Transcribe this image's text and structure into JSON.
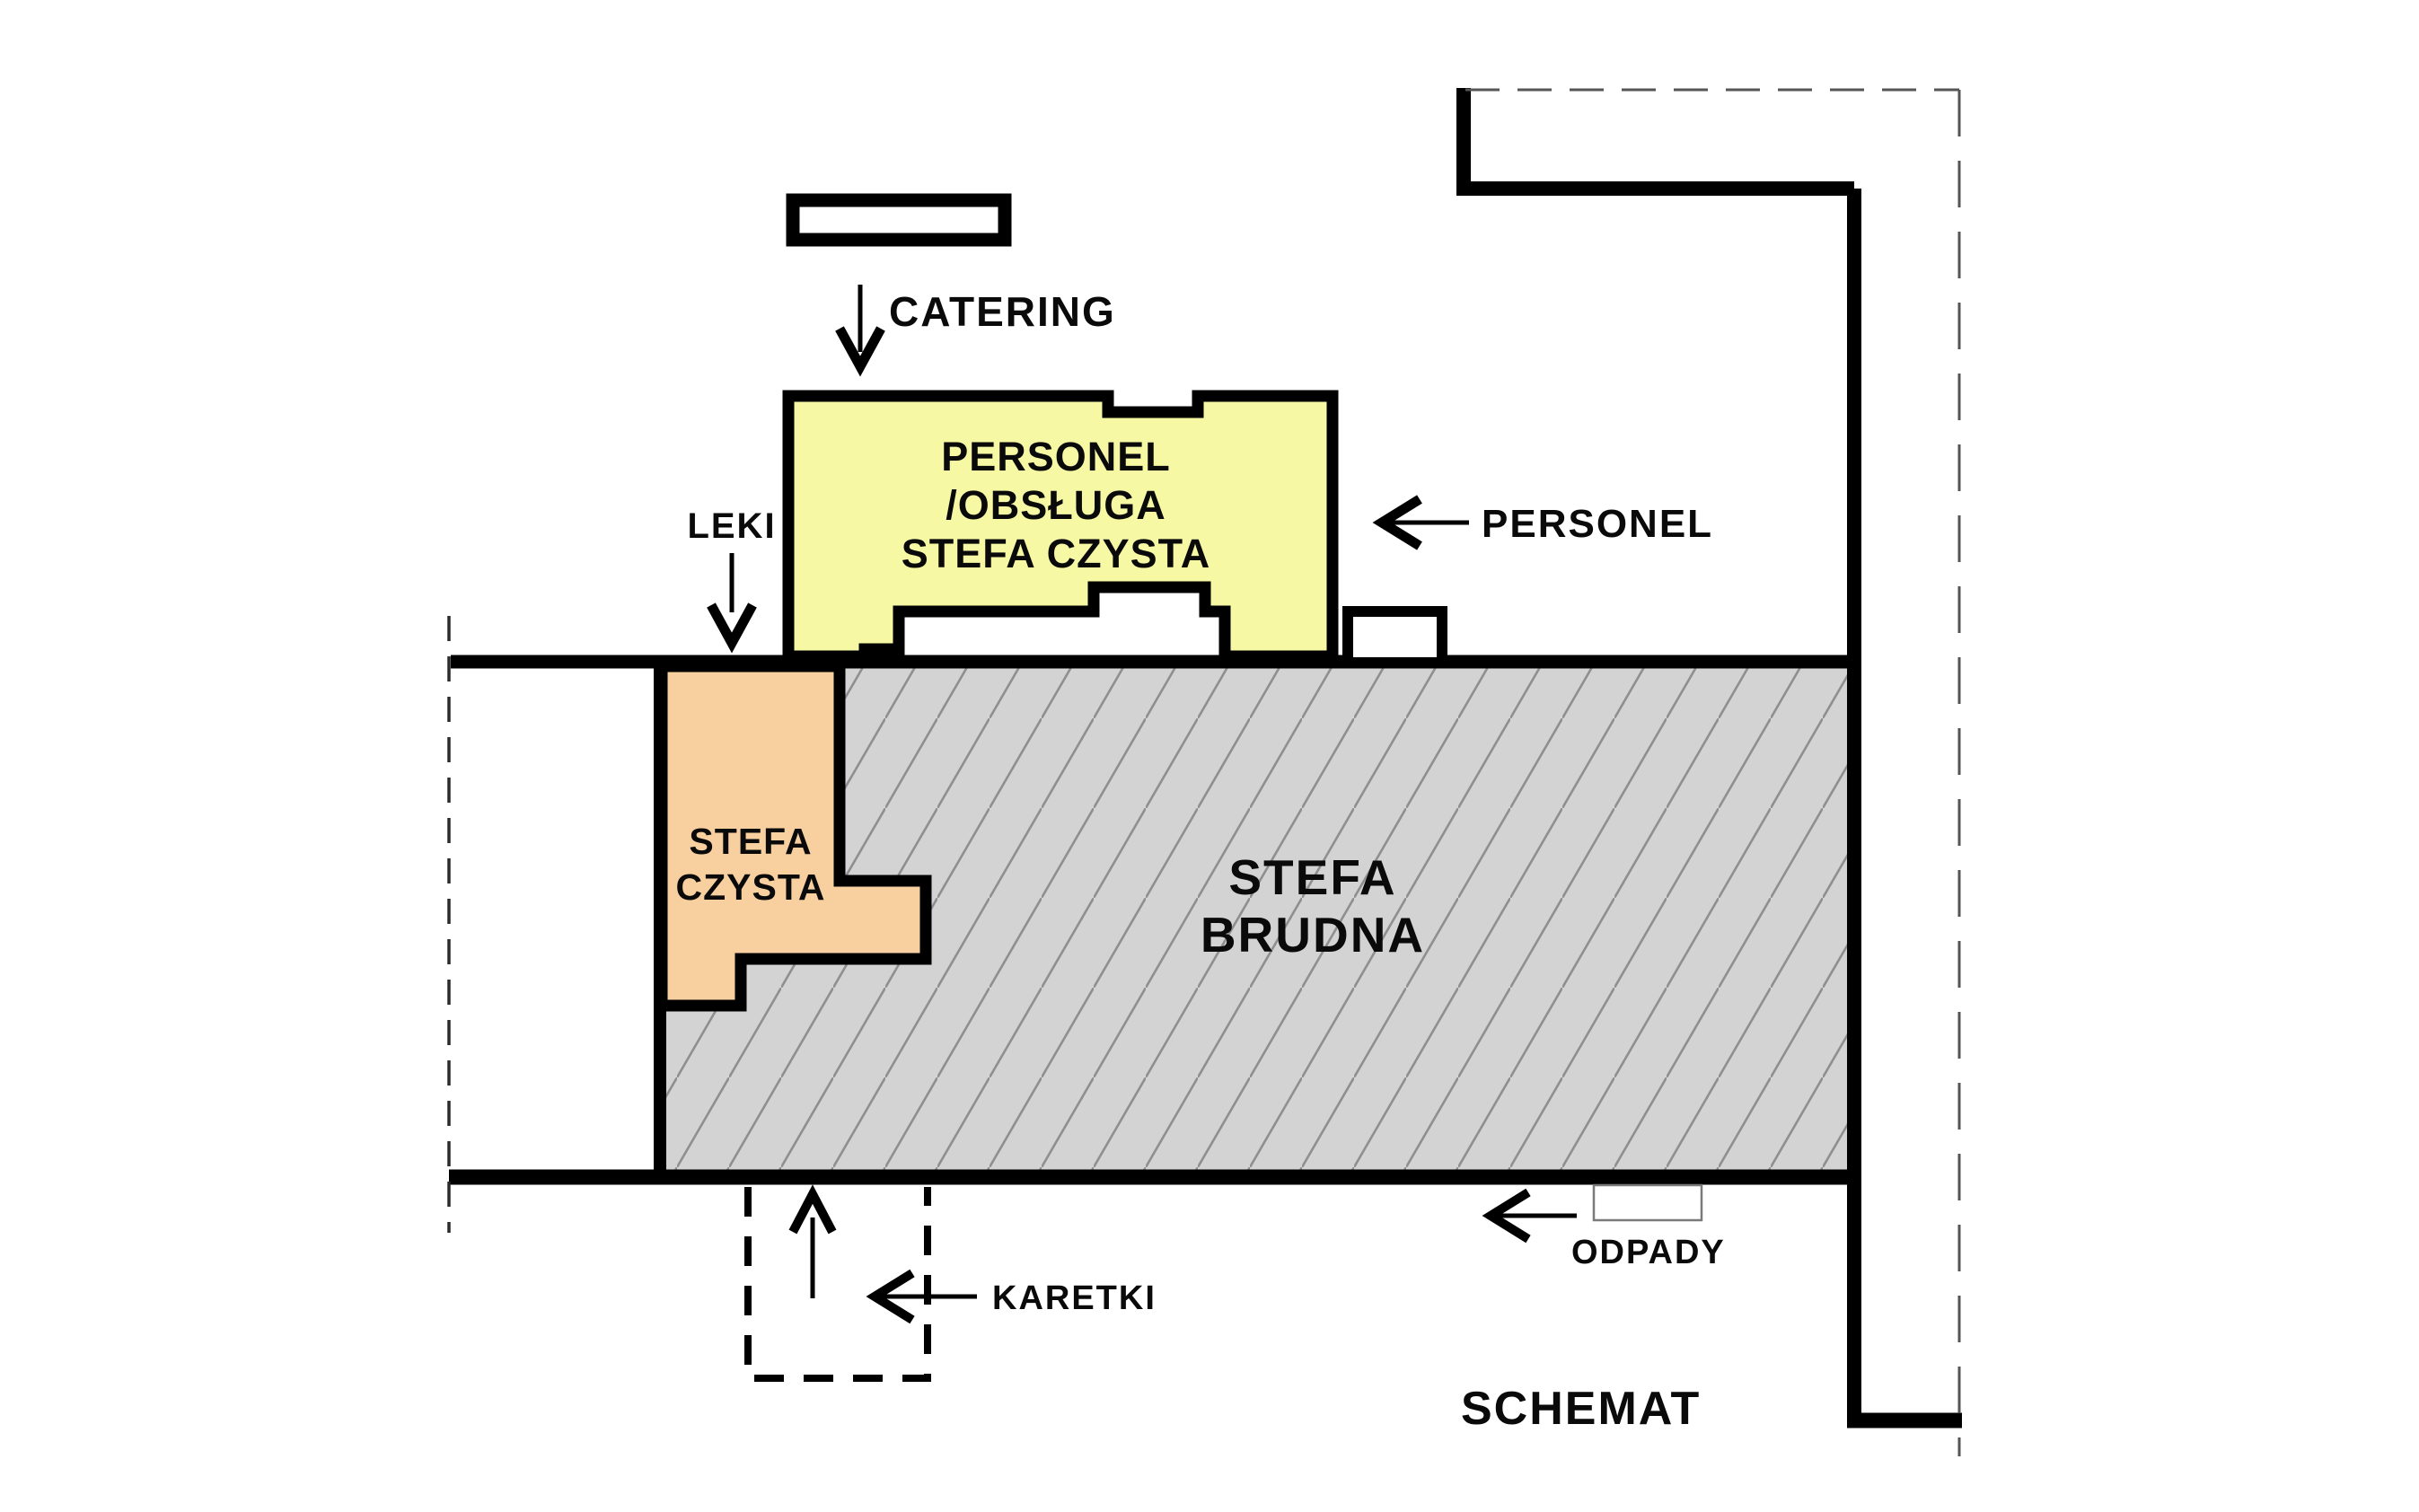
{
  "diagram": {
    "title": "SCHEMAT",
    "zones": {
      "personel_obsluga": {
        "line1": "PERSONEL",
        "line2": "/OBSŁUGA",
        "line3": "STEFA CZYSTA",
        "fill": "#f6f8a3"
      },
      "stefa_czysta": {
        "line1": "STEFA",
        "line2": "CZYSTA",
        "fill": "#f8d0a0"
      },
      "stefa_brudna": {
        "line1": "STEFA",
        "line2": "BRUDNA",
        "fill": "#d3d3d3",
        "hatch_color": "#8f8f8f"
      }
    },
    "flows": {
      "catering": "CATERING",
      "personel": "PERSONEL",
      "leki": "LEKI",
      "karetki": "KARETKI",
      "odpady": "ODPADY"
    },
    "colors": {
      "wall": "#000000",
      "text": "#0a0a0a",
      "dashed_thin": "#555555",
      "dashed_left": "#2a2a2a",
      "odpady_box_stroke": "#7a7a7a"
    }
  }
}
